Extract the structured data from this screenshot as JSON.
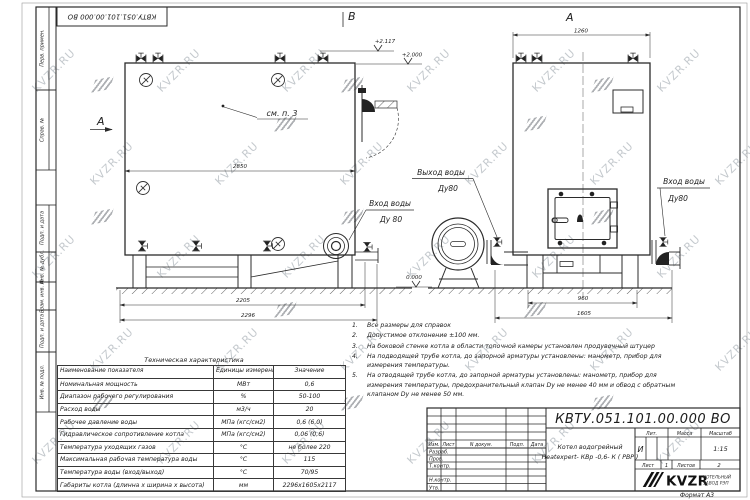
{
  "watermark": {
    "text": "KVZR.RU"
  },
  "frame": {
    "stamp_top": "КВТУ.051.101.00.000  ВО",
    "left_labels": [
      "Перв. примен.",
      "Справ. №",
      "Подп. и дата",
      "Инв. № дубл.",
      "Взам. инв. №",
      "Подп. и дата",
      "Инв. № подл."
    ],
    "format_note": "Формат  А3"
  },
  "drawing": {
    "view_marker_left": "А",
    "view_marker_top": "В",
    "view_label_right": "А",
    "callout_see_note": "см. п. 3",
    "labels": {
      "outlet_line1": "Выход воды",
      "outlet_line2": "Ду80",
      "inlet_left_line1": "Вход воды",
      "inlet_left_line2": "Ду 80",
      "inlet_right_line1": "Вход воды",
      "inlet_right_line2": "Ду80"
    },
    "levels": {
      "top1": "+2.117",
      "top2": "+2.000",
      "zero": "0.000"
    },
    "dims": {
      "side_width": "2850",
      "side_base1": "2205",
      "side_base2": "2296",
      "front_width": "1260",
      "front_base1": "960",
      "front_base2": "1605"
    }
  },
  "notes": [
    {
      "n": "1.",
      "t": "Все размеры для справок"
    },
    {
      "n": "2.",
      "t": "Допустимое отклонение  ±100 мм."
    },
    {
      "n": "3.",
      "t": "На боковой стенке котла в области топочной камеры установлен продувочный штуцер"
    },
    {
      "n": "4.",
      "t": "На  подводящей трубе котла, до запорной арматуры установлены:  манометр, прибор для измерения температуры."
    },
    {
      "n": "5.",
      "t": "На отводящей трубе котла, до запорной арматуры установлены:  манометр, прибор для измерения температуры, предохранительный клапан  Dу не менее  40 мм и обвод с обратным клапаном  Dу не менее  50 мм."
    }
  ],
  "spec_table": {
    "title": "Техническая характеристика",
    "headers": [
      "Наименование показателя",
      "Единицы измерения",
      "Значение"
    ],
    "rows": [
      [
        "Номинальная мощность",
        "МВт",
        "0,6"
      ],
      [
        "Диапазон рабочего регулирования",
        "%",
        "50-100"
      ],
      [
        "Расход воды",
        "м3/ч",
        "20"
      ],
      [
        "Рабочее давление воды",
        "МПа (кгс/см2)",
        "0,6 (6,0)"
      ],
      [
        "Гидравлическое сопротивление котла",
        "МПа (кгс/см2)",
        "0,06 (0,6)"
      ],
      [
        "Температура уходящих газов",
        "°С",
        "не более 220"
      ],
      [
        "Максимальная рабочая температура воды",
        "°С",
        "115"
      ],
      [
        "Температура воды (вход/выход)",
        "°С",
        "70/95"
      ],
      [
        "Габариты котла (длинна х ширина х высота)",
        "мм",
        "2296х1605х2117"
      ]
    ]
  },
  "titleblock": {
    "designation": "КВТУ.051.101.00.000  ВО",
    "rev_headers": [
      "Изм.",
      "Лист",
      "N докум.",
      "Подп.",
      "Дата"
    ],
    "sign_rows": [
      "Разраб.",
      "Пров.",
      "Т.контр.",
      "",
      "Н.контр.",
      "Утв."
    ],
    "product_line1": "Котел водогрейный",
    "product_line2": "Heatexpert- КВр -0,6- К ( РВР )",
    "lit_label": "Лит.",
    "mass_label": "Масса",
    "scale_label": "Масштаб",
    "lit_value": "И",
    "scale_value": "1:15",
    "sheet_label": "Лист",
    "sheet_value": "1",
    "sheets_label": "Листов",
    "sheets_value": "2",
    "logo_text": "KVZR",
    "company_line1": "КОТЕЛЬНЫЙ",
    "company_line2": "ЗАВОД РЭП"
  }
}
